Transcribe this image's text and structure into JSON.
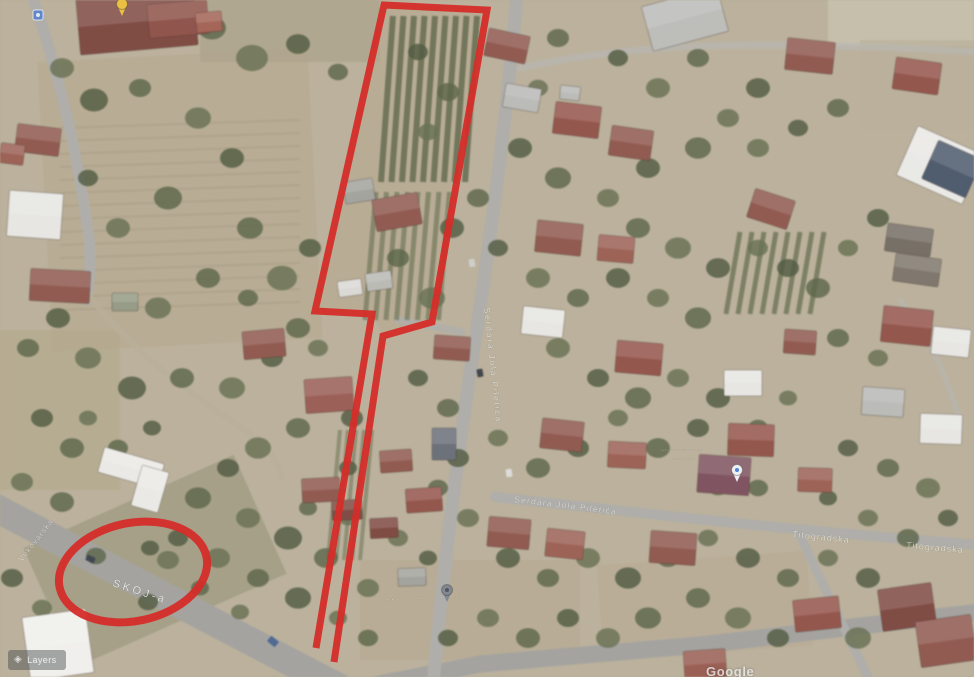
{
  "map": {
    "kind": "satellite-view",
    "background_tone": "#b5a98f"
  },
  "watermark": {
    "text": "Google"
  },
  "controls": {
    "layers_label": "Layers"
  },
  "street_labels": [
    {
      "id": "skoj-a",
      "text": "SKOJ-a",
      "x": 112,
      "y": 586,
      "rotate": 18,
      "size": 11,
      "spacing": 3,
      "opacity": 0.78
    },
    {
      "id": "vukovarska",
      "text": "Vukovarska",
      "x": 22,
      "y": 562,
      "rotate": -52,
      "size": 8,
      "spacing": 1,
      "opacity": 0.5
    },
    {
      "id": "main-road",
      "text": "Serdara Jola Piletića",
      "x": 484,
      "y": 308,
      "rotate": 84,
      "size": 8.5,
      "spacing": 1.8,
      "opacity": 0.6
    },
    {
      "id": "cross-road",
      "text": "Serdara Jola Piletića",
      "x": 514,
      "y": 502,
      "rotate": 7,
      "size": 8.5,
      "spacing": 1.2,
      "opacity": 0.55
    },
    {
      "id": "titogradska-1",
      "text": "Titogradska",
      "x": 792,
      "y": 537,
      "rotate": 6,
      "size": 9,
      "spacing": 1,
      "opacity": 0.58
    },
    {
      "id": "titogradska-2",
      "text": "Titogradska",
      "x": 906,
      "y": 548,
      "rotate": 5,
      "size": 9,
      "spacing": 1,
      "opacity": 0.58
    },
    {
      "id": "bottom-road",
      "text": "··· ······ ·····",
      "x": 386,
      "y": 602,
      "rotate": -2,
      "size": 9,
      "spacing": 2,
      "opacity": 0.5
    }
  ],
  "poi_labels": [
    {
      "text": "········ ···· ·····",
      "x": 660,
      "y": 452,
      "size": 7
    },
    {
      "text": "······ ···",
      "x": 672,
      "y": 461,
      "size": 7
    }
  ],
  "annotations": {
    "color": "#d32420",
    "parcel_outline": {
      "stroke_width": 7,
      "points": "316,648 372,314 315,311 384,5 487,10 432,322 383,336 334,662"
    },
    "highlight_ellipse": {
      "cx": 133,
      "cy": 572,
      "rx": 75,
      "ry": 49,
      "rotate": -12,
      "stroke_width": 8
    }
  },
  "pins": [
    {
      "name": "yellow-pin",
      "x": 122,
      "y": 10,
      "color": "#e9bd3c"
    },
    {
      "name": "blue-sign",
      "x": 38,
      "y": 15,
      "color": "#5a82c8"
    },
    {
      "name": "gray-pin",
      "x": 447,
      "y": 596,
      "color": "#7e828c"
    },
    {
      "name": "white-pin",
      "x": 737,
      "y": 476,
      "color": "#eef0f4"
    }
  ]
}
